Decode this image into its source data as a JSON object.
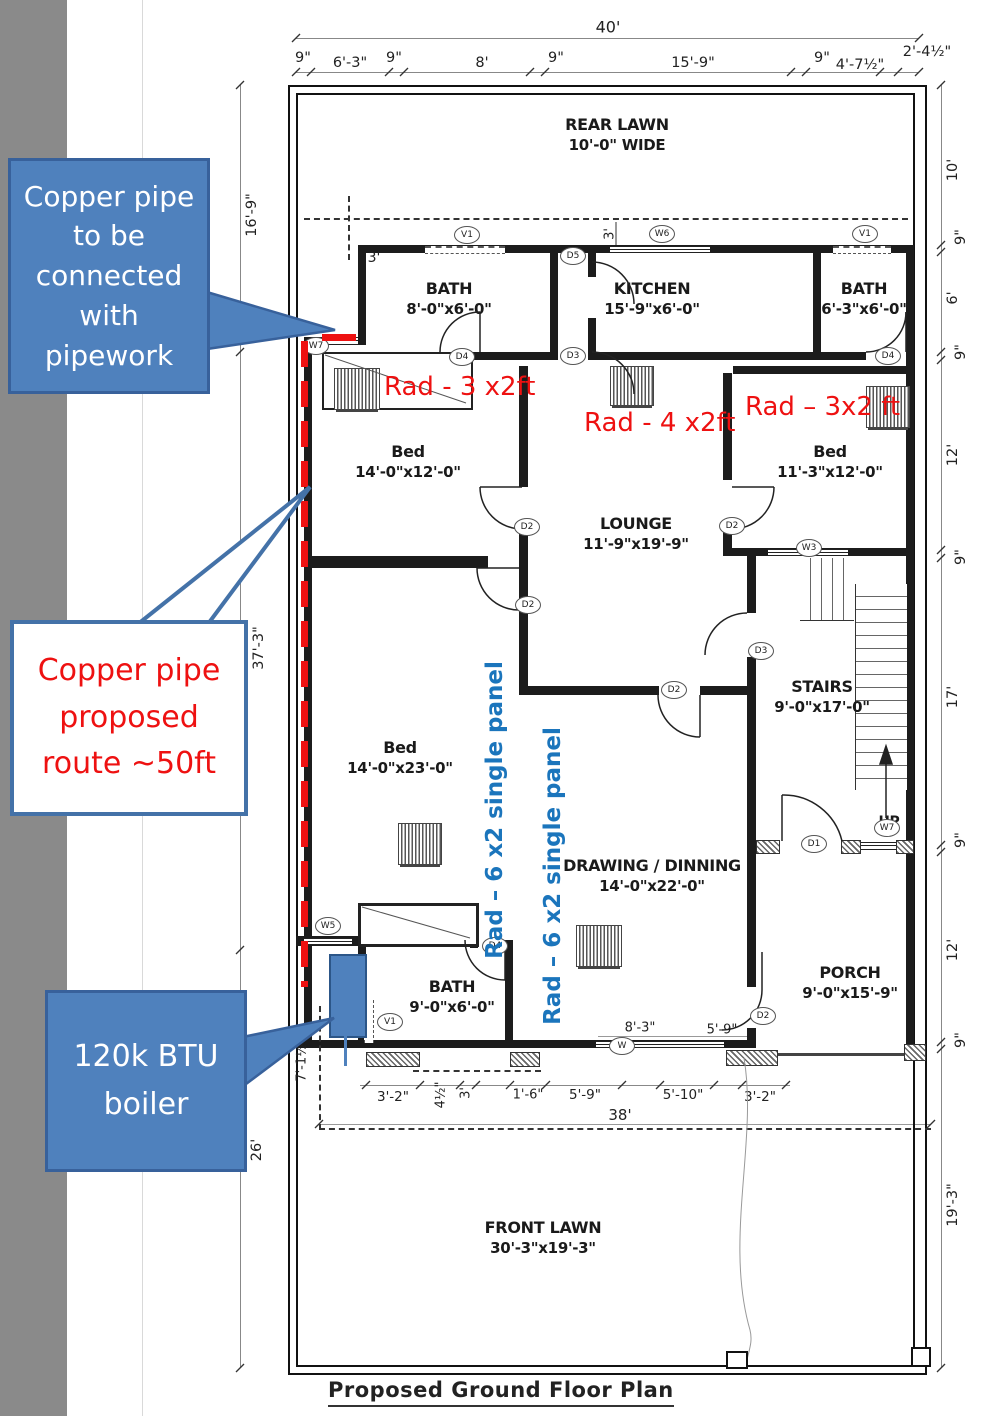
{
  "palette": {
    "accent_blue": "#4f81bd",
    "accent_blue_border": "#38619b",
    "annotation_red": "#ee1111",
    "rad_blue": "#1b75bc",
    "wall_black": "#1c1c1c",
    "sidebar_gray": "#8a8a8a"
  },
  "title": "Proposed Ground Floor Plan",
  "callouts": {
    "pipe_connect": {
      "text": "Copper pipe to be connected with pipework"
    },
    "pipe_route": {
      "text": "Copper pipe proposed route ~50ft"
    },
    "boiler": {
      "text": "120k BTU boiler"
    }
  },
  "annotations": {
    "rad1": "Rad - 3 x2ft",
    "rad2": "Rad - 4 x2ft",
    "rad3": "Rad – 3x2 ft",
    "rad_panel1": "Rad – 6 x2 single panel",
    "rad_panel2": "Rad – 6 x2 single panel",
    "up": "UP"
  },
  "rooms": [
    {
      "line1": "REAR LAWN",
      "line2": "10'-0\" WIDE"
    },
    {
      "line1": "BATH",
      "line2": "8'-0\"x6'-0\""
    },
    {
      "line1": "KITCHEN",
      "line2": "15'-9\"x6'-0\""
    },
    {
      "line1": "BATH",
      "line2": "6'-3\"x6'-0\""
    },
    {
      "line1": "Bed",
      "line2": "14'-0\"x12'-0\""
    },
    {
      "line1": "LOUNGE",
      "line2": "11'-9\"x19'-9\""
    },
    {
      "line1": "Bed",
      "line2": "11'-3\"x12'-0\""
    },
    {
      "line1": "STAIRS",
      "line2": "9'-0\"x17'-0\""
    },
    {
      "line1": "Bed",
      "line2": "14'-0\"x23'-0\""
    },
    {
      "line1": "DRAWING / DINNING",
      "line2": "14'-0\"x22'-0\""
    },
    {
      "line1": "BATH",
      "line2": "9'-0\"x6'-0\""
    },
    {
      "line1": "PORCH",
      "line2": "9'-0\"x15'-9\""
    },
    {
      "line1": "FRONT LAWN",
      "line2": "30'-3\"x19'-3\""
    }
  ],
  "openings": [
    {
      "label": "V1"
    },
    {
      "label": "W6"
    },
    {
      "label": "V1"
    },
    {
      "label": "D5"
    },
    {
      "label": "W7"
    },
    {
      "label": "D4"
    },
    {
      "label": "D3"
    },
    {
      "label": "D4"
    },
    {
      "label": "D2"
    },
    {
      "label": "D2"
    },
    {
      "label": "W3"
    },
    {
      "label": "D2"
    },
    {
      "label": "D3"
    },
    {
      "label": "D2"
    },
    {
      "label": "W7"
    },
    {
      "label": "D1"
    },
    {
      "label": "W5"
    },
    {
      "label": "D4"
    },
    {
      "label": "V1"
    },
    {
      "label": "D2"
    },
    {
      "label": "W"
    }
  ],
  "dimensions": {
    "top_total": "40'",
    "top": [
      "9\"",
      "6'-3\"",
      "9\"",
      "8'",
      "9\"",
      "15'-9\"",
      "9\"",
      "4'-7½\"",
      "2'-4½\""
    ],
    "right": [
      "10'",
      "9\"",
      "6'",
      "9\"",
      "12'",
      "9\"",
      "17'",
      "9\"",
      "12'",
      "9\"",
      "19'-3\""
    ],
    "left": [
      "16'-9\"",
      "37'-3\"",
      "26'",
      "7'-1½\""
    ],
    "bottom": [
      "3'-2\"",
      "4½\"",
      "3'",
      "1'-6\"",
      "5'-9\"",
      "5'-10\"",
      "3'-2\""
    ],
    "bottom_total": "38'",
    "inner": [
      "3'",
      "3'",
      "8'-3\"",
      "5'-9\""
    ]
  }
}
